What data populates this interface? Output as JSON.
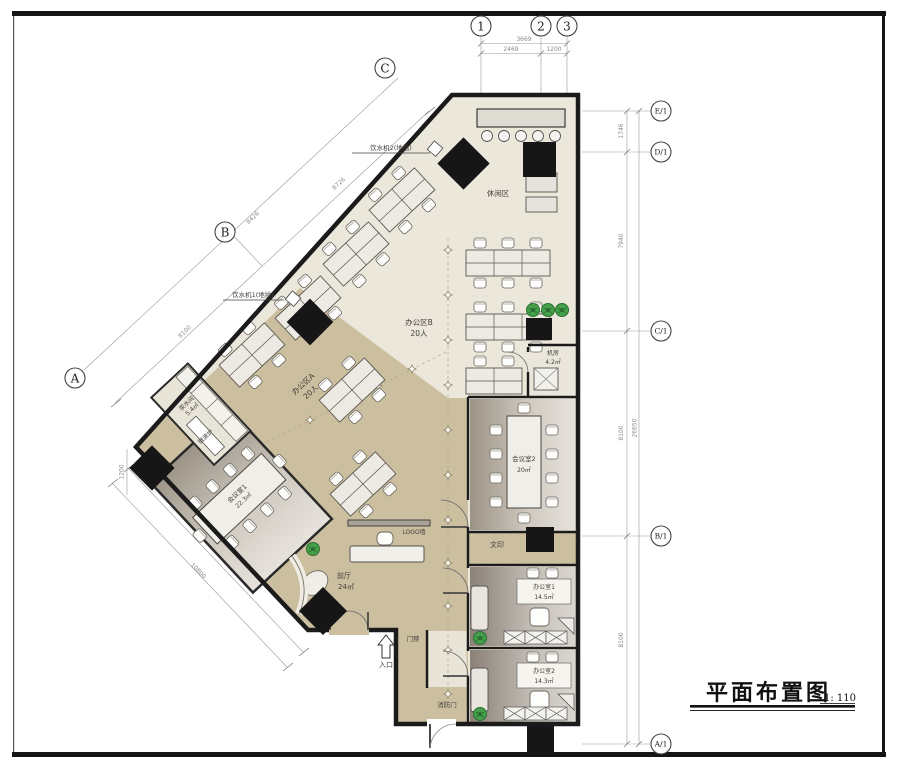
{
  "sheet": {
    "title": "平面布置图",
    "scale": "1: 110"
  },
  "grid": {
    "top": {
      "bubbles": [
        "1",
        "2",
        "3"
      ],
      "total": "3669",
      "segments": [
        "2469",
        "1200"
      ]
    },
    "diag": {
      "bubbles": [
        "C",
        "B",
        "A"
      ],
      "dims": [
        "8726",
        "8426",
        "8100"
      ]
    },
    "right": {
      "bubbles": [
        "E/1",
        "D/1",
        "C/1",
        "B/1",
        "A/1"
      ],
      "segments": [
        "1746",
        "7940",
        "8100",
        "8100"
      ],
      "total": "26650"
    },
    "lower": {
      "vertical": "1200",
      "outer": "10800",
      "inner": "9600"
    }
  },
  "rooms": {
    "leisure": "休闲区",
    "office_b": {
      "name": "办公区B",
      "capacity": "20人"
    },
    "office_a": {
      "name": "办公区A",
      "capacity": "20人"
    },
    "server": {
      "name": "机房",
      "area": "4.2㎡"
    },
    "meeting2": {
      "name": "会议室2",
      "area": "20㎡"
    },
    "meeting1": {
      "name": "会议室1",
      "area": "22.3㎡"
    },
    "tea": {
      "name": "茶水间",
      "area": "5.4㎡"
    },
    "lobby": {
      "name": "前厅",
      "area": "24㎡"
    },
    "print": "文印",
    "office1": {
      "name": "办公室1",
      "area": "14.5㎡"
    },
    "office2": {
      "name": "办公室2",
      "area": "14.3㎡"
    }
  },
  "annotations": {
    "water2": "饮水机2(地插)",
    "water1": "饮水机1(地插)",
    "microwave": "微波炉",
    "logo": "LOGO墙",
    "access": "门禁",
    "entry": "入口",
    "fire": "消防门"
  },
  "colors": {
    "wall": "#1b1b1b",
    "floor_light": "#ece7db",
    "floor_tan": "#cbbfa0",
    "room_dark": "#9c9386",
    "plant": "#45a049",
    "column": "#161616"
  }
}
